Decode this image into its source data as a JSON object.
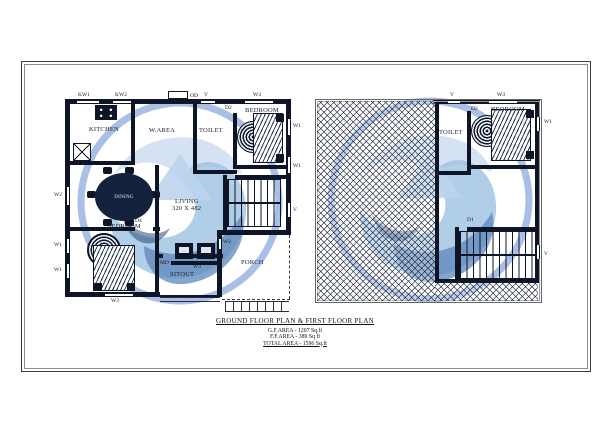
{
  "sheet": {
    "title": "GROUND FLOOR PLAN & FIRST FLOOR PLAN",
    "area_lines": [
      "G.F.AREA - 1207 Sq.ft",
      "F.F.AREA - 389 Sq ft",
      "TOTAL AREA - 1596 Sq.ft"
    ]
  },
  "gf": {
    "rooms": {
      "kitchen": "KITCHEN",
      "warea": "W.AREA",
      "toilet": "TOILET",
      "bedroom1": "BEDROOM",
      "dining": "DINING",
      "living1": "LIVING",
      "living2": "320 X 482",
      "bedroom2": "BEDROOM",
      "sitout": "SITOUT",
      "porch": "PORCH"
    },
    "labels": {
      "kw1": "KW1",
      "kw2": "KW2",
      "od": "OD",
      "v": "V",
      "w3": "W3",
      "w1": "W1",
      "w2": "W2",
      "md": "MD",
      "d1": "D1",
      "d2": "D2",
      "d4": "D4"
    }
  },
  "ff": {
    "rooms": {
      "toilet": "TOILET",
      "bedroom": "BEDROOM"
    },
    "labels": {
      "v": "V",
      "w3": "W3",
      "w1": "W1",
      "d1": "D1",
      "d2": "D2"
    }
  },
  "colors": {
    "wall": "#0d1526",
    "watermark_ring": "#a9bfe6",
    "watermark_light": "#cfdff2",
    "watermark_mid": "#9dc2e2",
    "watermark_deep": "#5d87bb"
  }
}
